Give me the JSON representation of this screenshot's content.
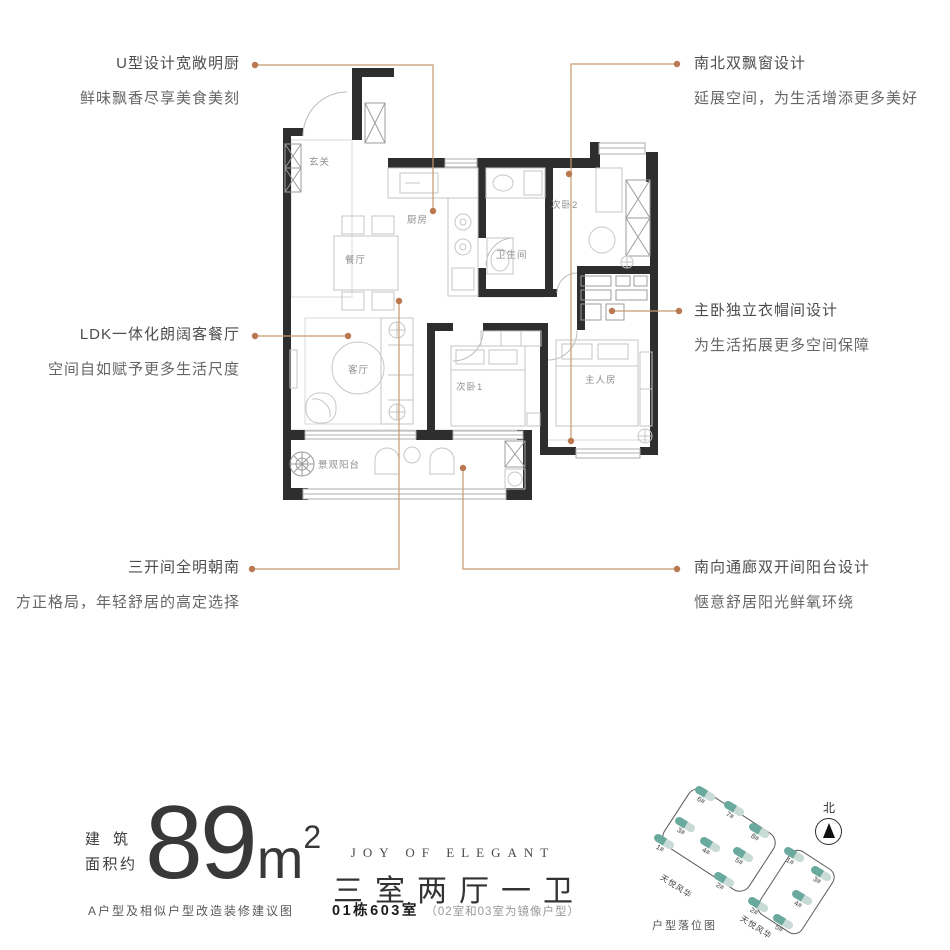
{
  "callouts": {
    "kitchen": {
      "title": "U型设计宽敞明厨",
      "subtitle": "鲜味飘香尽享美食美刻"
    },
    "bay_windows": {
      "title": "南北双飘窗设计",
      "subtitle": "延展空间，为生活增添更多美好"
    },
    "ldk": {
      "title": "LDK一体化朗阔客餐厅",
      "subtitle": "空间自如赋予更多生活尺度"
    },
    "cloakroom": {
      "title": "主卧独立衣帽间设计",
      "subtitle": "为生活拓展更多空间保障"
    },
    "south_rooms": {
      "title": "三开间全明朝南",
      "subtitle": "方正格局，年轻舒居的高定选择"
    },
    "balcony": {
      "title": "南向通廊双开间阳台设计",
      "subtitle": "惬意舒居阳光鲜氧环绕"
    }
  },
  "rooms": {
    "entry": "玄关",
    "kitchen": "厨房",
    "dining": "餐厅",
    "bathroom": "卫生间",
    "bedroom2": "次卧2",
    "living": "客厅",
    "bedroom1": "次卧1",
    "master": "主人房",
    "balcony": "景观阳台"
  },
  "summary": {
    "area_label_line1": "建筑",
    "area_label_line2": "面积约",
    "area_value": "89",
    "area_unit": "m",
    "area_exponent": "2",
    "slogan": "JOY OF ELEGANT",
    "layout": "三室两厅一卫",
    "disclaimer": "A户型及相似户型改造装修建议图",
    "unit": "01栋603室",
    "unit_note": "（02室和03室为镜像户型）"
  },
  "siteplan": {
    "caption": "户型落位图",
    "north": "北",
    "parcel1": {
      "name": "天悦风华",
      "buildings": [
        "6#",
        "7#",
        "3#",
        "8#",
        "1#",
        "4#",
        "5#",
        "2#"
      ]
    },
    "parcel2": {
      "name": "天悦风华",
      "buildings": [
        "1#",
        "3#",
        "4#",
        "2#",
        "5#"
      ]
    }
  },
  "colors": {
    "wall": "#2e2e2e",
    "leader_line": "#c89a6e",
    "leader_dot": "#b9784f",
    "furniture_line": "#c6c6c6",
    "building_teal": "#6aaa9e"
  }
}
